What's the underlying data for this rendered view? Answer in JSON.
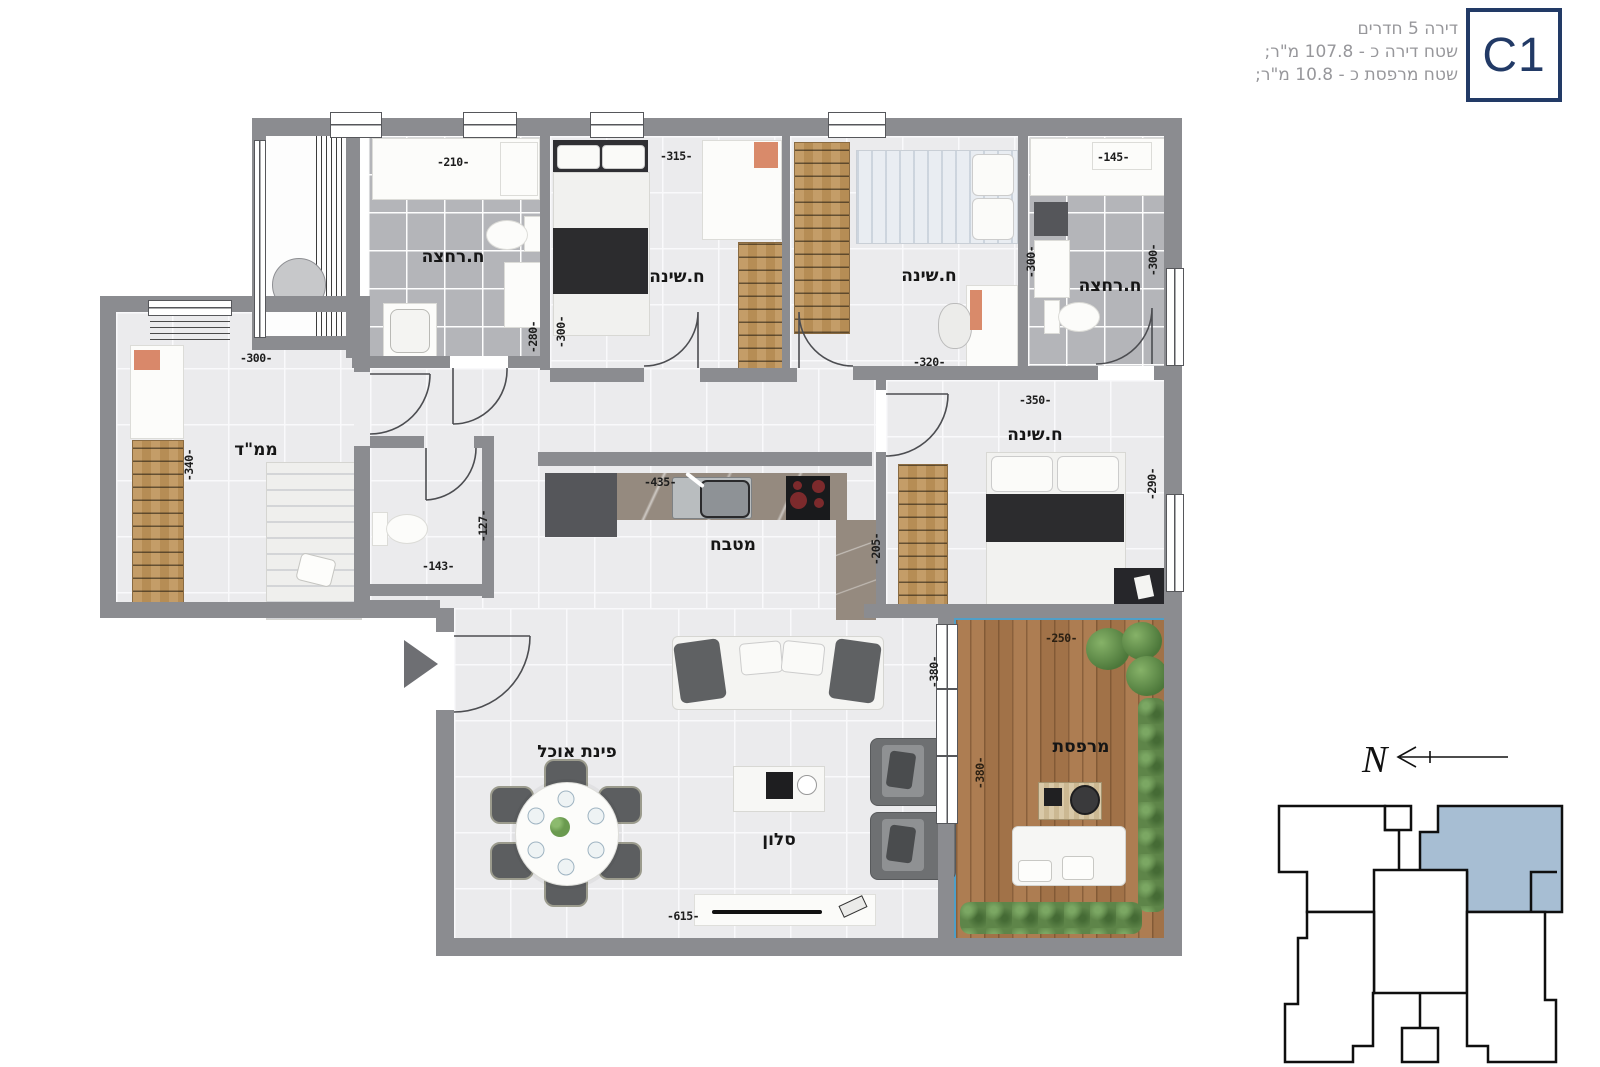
{
  "header": {
    "unit": "C1",
    "line1": "דירה 5 חדרים",
    "line2": "שטח דירה כ - 107.8 מ\"ר;",
    "line3": "שטח מרפסת כ - 10.8 מ\"ר;"
  },
  "rooms": {
    "bath1": "ח.רחצה",
    "bed1": "ח.שינה",
    "bed2": "ח.שינה",
    "bath2": "ח.רחצה",
    "mamad": "ממ\"ד",
    "kitchen": "מטבח",
    "master": "ח.שינה",
    "dining": "פינת אוכל",
    "living": "סלון",
    "balcony": "מרפסת"
  },
  "dims": {
    "bath1_width": "-210-",
    "bed1_width": "-315-",
    "bath2_width": "-145-",
    "bath1_depth": "-280-",
    "bed1_depth": "-300-",
    "bed2_width": "-320-",
    "bed2_depth": "-300-",
    "bath2_depth": "-300-",
    "mamad_width": "-300-",
    "mamad_depth": "-340-",
    "wc_width": "-143-",
    "wc_depth": "-127-",
    "kitchen_width": "-435-",
    "kitchen_depth": "-205-",
    "master_width": "-350-",
    "master_depth": "-290-",
    "living_width": "-615-",
    "living_depth": "-380-",
    "balcony_width": "-250-",
    "balcony_depth": "-380-"
  },
  "keyplan": {
    "north_label": "N"
  },
  "colors": {
    "accent_navy": "#223a66",
    "keyplan_highlight": "#a7bed3",
    "wall_gray": "#8b8c90",
    "balcony_edge": "#4f9fc8"
  }
}
